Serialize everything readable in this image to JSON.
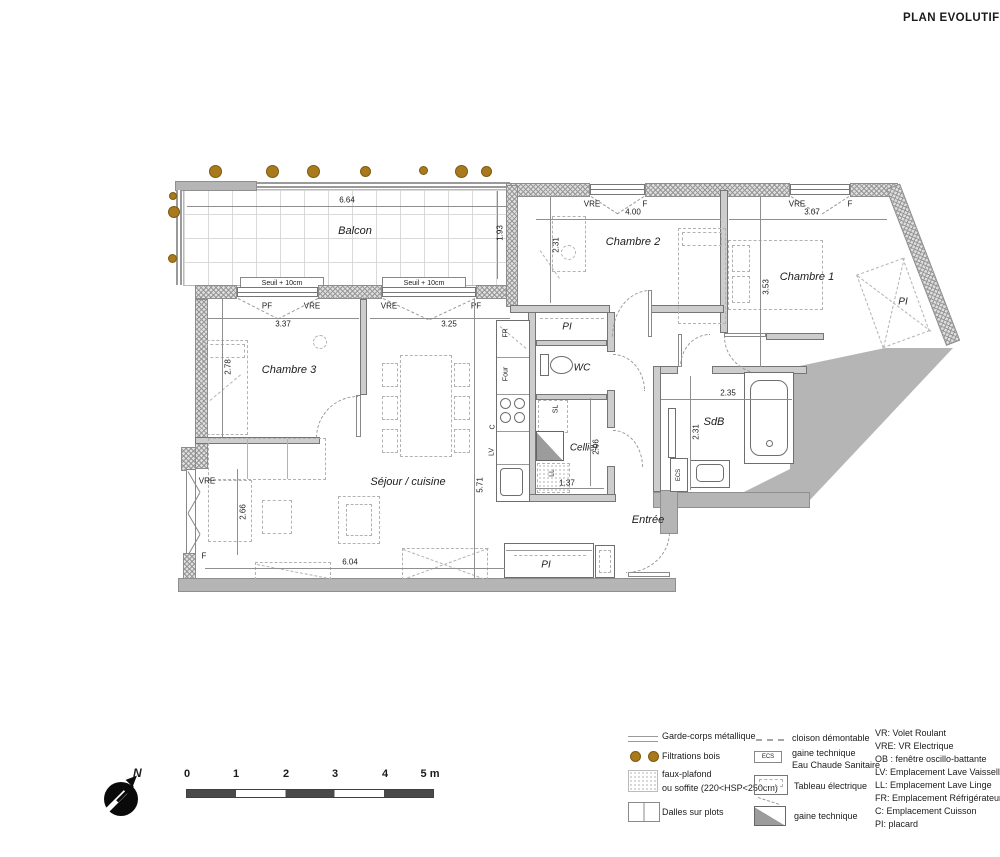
{
  "title": "PLAN EVOLUTIF",
  "north_label": "N",
  "rooms": {
    "balcon": "Balcon",
    "chambre1": "Chambre 1",
    "chambre2": "Chambre 2",
    "chambre3": "Chambre 3",
    "sejour": "Séjour / cuisine",
    "wc": "WC",
    "cellier": "Cellier",
    "sdb": "SdB",
    "entree": "Entrée",
    "pi": "PI"
  },
  "sill": "Seuil + 10cm",
  "dims": {
    "d664": "6.64",
    "d193": "1.93",
    "d400": "4.00",
    "d231": "2.31",
    "d307": "3.07",
    "d353": "3.53",
    "d337": "3.37",
    "d325": "3.25",
    "d278": "2.78",
    "d266": "2.66",
    "d604": "6.04",
    "d571": "5.71",
    "d137": "1.37",
    "d206": "2.06",
    "d235": "2.35"
  },
  "tags": {
    "vre": "VRE",
    "f": "F",
    "pf": "PF",
    "fr": "FR",
    "four": "Four",
    "c": "C",
    "lv": "LV",
    "sl": "SL",
    "ll": "LL",
    "ecs": "ECS"
  },
  "legend": {
    "garde_corps": "Garde-corps métallique",
    "filtrations": "Filtrations bois",
    "faux_plafond_1": "faux-plafond",
    "faux_plafond_2": "ou soffite (220<HSP<250cm)",
    "dalles": "Dalles sur plots",
    "cloison": "cloison démontable",
    "gaine_ecs_1": "gaine technique",
    "gaine_ecs_2": "Eau Chaude Sanitaire",
    "ecs_tag": "ECS",
    "tableau": "Tableau électrique",
    "gaine": "gaine technique",
    "abbr": [
      "VR: Volet Roulant",
      "VRE: VR Electrique",
      "OB : fenêtre oscillo-battante",
      "LV: Emplacement Lave Vaisselle",
      "LL: Emplacement Lave Linge",
      "FR: Emplacement Réfrigérateur",
      "C: Emplacement Cuisson",
      "PI: placard"
    ]
  },
  "scale": {
    "t0": "0",
    "t1": "1",
    "t2": "2",
    "t3": "3",
    "t4": "4",
    "t5": "5 m"
  },
  "colors": {
    "filtration_dot": "#a87a1c",
    "wall_gray": "#b5b5b5",
    "dark": "#0a0a0a"
  }
}
